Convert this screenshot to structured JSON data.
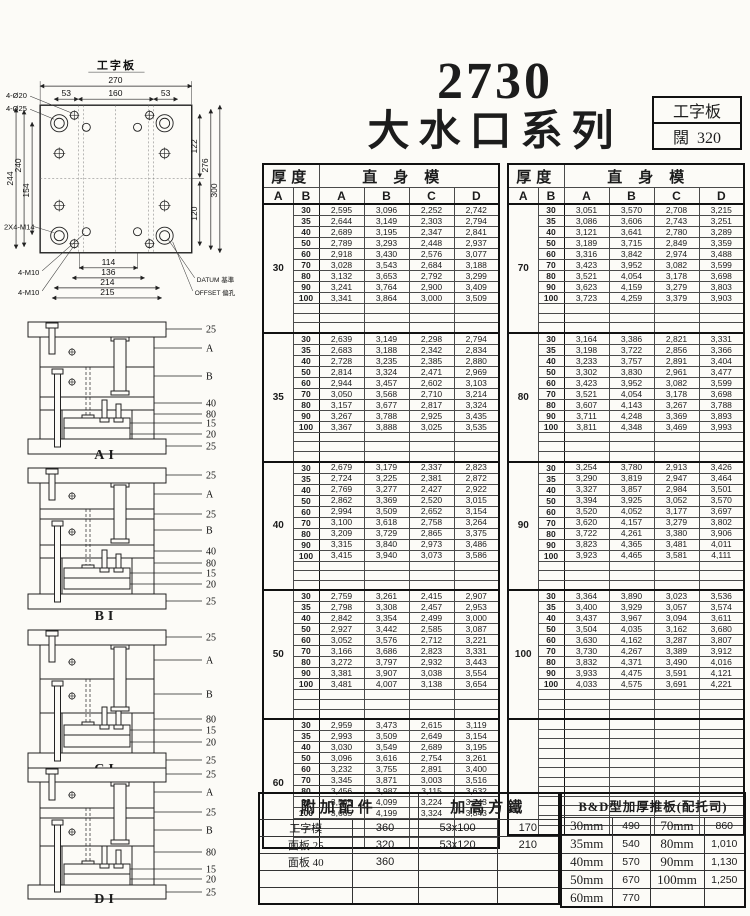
{
  "title": {
    "model": "2730",
    "series": "大水口系列"
  },
  "info_box": {
    "type": "工字板",
    "width_label": "闊",
    "width_value": "320"
  },
  "drawing": {
    "title": "工字板",
    "dim_270": "270",
    "dim_160": "160",
    "dim_53_left": "53",
    "dim_53_right": "53",
    "dim_244": "244",
    "dim_240": "240",
    "dim_154": "154",
    "dim_122": "122",
    "dim_120": "120",
    "dim_276": "276",
    "dim_300": "300",
    "dim_114": "114",
    "dim_136": "136",
    "dim_214": "214",
    "dim_215": "215",
    "label_holes_20": "4-Ø20",
    "label_holes_25": "4-Ø25",
    "label_m14": "2X4-M14",
    "label_m10_a": "4-M10",
    "label_m10_b": "4-M10",
    "label_datum": "DATUM 基準",
    "label_offset": "OFFSET 偏孔"
  },
  "diagrams": [
    {
      "name": "AI",
      "callouts": [
        "25",
        "A",
        "B",
        "40",
        "80",
        "15",
        "20",
        "25"
      ]
    },
    {
      "name": "BI",
      "callouts": [
        "25",
        "A",
        "25",
        "B",
        "40",
        "80",
        "15",
        "20",
        "25"
      ]
    },
    {
      "name": "CI",
      "callouts": [
        "25",
        "A",
        "B",
        "80",
        "15",
        "20",
        "25"
      ]
    },
    {
      "name": "DI",
      "callouts": [
        "25",
        "A",
        "25",
        "B",
        "80",
        "15",
        "20",
        "25"
      ]
    }
  ],
  "price_table": {
    "header": {
      "thickness": "厚度",
      "straight": "直身模",
      "a": "A",
      "b": "B",
      "col_a": "A",
      "col_b": "B",
      "col_c": "C",
      "col_d": "D"
    },
    "rows_per_block": 12,
    "right_trailing_empty_rows": 12,
    "left_blocks": [
      {
        "a": "30",
        "rows": [
          [
            "30",
            "2,595",
            "3,096",
            "2,252",
            "2,742"
          ],
          [
            "35",
            "2,644",
            "3,149",
            "2,303",
            "2,794"
          ],
          [
            "40",
            "2,689",
            "3,195",
            "2,347",
            "2,841"
          ],
          [
            "50",
            "2,789",
            "3,293",
            "2,448",
            "2,937"
          ],
          [
            "60",
            "2,918",
            "3,430",
            "2,576",
            "3,077"
          ],
          [
            "70",
            "3,028",
            "3,543",
            "2,684",
            "3,188"
          ],
          [
            "80",
            "3,132",
            "3,653",
            "2,792",
            "3,299"
          ],
          [
            "90",
            "3,241",
            "3,764",
            "2,900",
            "3,409"
          ],
          [
            "100",
            "3,341",
            "3,864",
            "3,000",
            "3,509"
          ]
        ]
      },
      {
        "a": "35",
        "rows": [
          [
            "30",
            "2,639",
            "3,149",
            "2,298",
            "2,794"
          ],
          [
            "35",
            "2,683",
            "3,188",
            "2,342",
            "2,834"
          ],
          [
            "40",
            "2,728",
            "3,235",
            "2,385",
            "2,880"
          ],
          [
            "50",
            "2,814",
            "3,324",
            "2,471",
            "2,969"
          ],
          [
            "60",
            "2,944",
            "3,457",
            "2,602",
            "3,103"
          ],
          [
            "70",
            "3,050",
            "3,568",
            "2,710",
            "3,214"
          ],
          [
            "80",
            "3,157",
            "3,677",
            "2,817",
            "3,324"
          ],
          [
            "90",
            "3,267",
            "3,788",
            "2,925",
            "3,435"
          ],
          [
            "100",
            "3,367",
            "3,888",
            "3,025",
            "3,535"
          ]
        ]
      },
      {
        "a": "40",
        "rows": [
          [
            "30",
            "2,679",
            "3,179",
            "2,337",
            "2,823"
          ],
          [
            "35",
            "2,724",
            "3,225",
            "2,381",
            "2,872"
          ],
          [
            "40",
            "2,769",
            "3,277",
            "2,427",
            "2,922"
          ],
          [
            "50",
            "2,862",
            "3,369",
            "2,520",
            "3,015"
          ],
          [
            "60",
            "2,994",
            "3,509",
            "2,652",
            "3,154"
          ],
          [
            "70",
            "3,100",
            "3,618",
            "2,758",
            "3,264"
          ],
          [
            "80",
            "3,209",
            "3,729",
            "2,865",
            "3,375"
          ],
          [
            "90",
            "3,315",
            "3,840",
            "2,973",
            "3,486"
          ],
          [
            "100",
            "3,415",
            "3,940",
            "3,073",
            "3,586"
          ]
        ]
      },
      {
        "a": "50",
        "rows": [
          [
            "30",
            "2,759",
            "3,261",
            "2,415",
            "2,907"
          ],
          [
            "35",
            "2,798",
            "3,308",
            "2,457",
            "2,953"
          ],
          [
            "40",
            "2,842",
            "3,354",
            "2,499",
            "3,000"
          ],
          [
            "50",
            "2,927",
            "3,442",
            "2,585",
            "3,087"
          ],
          [
            "60",
            "3,052",
            "3,576",
            "2,712",
            "3,221"
          ],
          [
            "70",
            "3,166",
            "3,686",
            "2,823",
            "3,331"
          ],
          [
            "80",
            "3,272",
            "3,797",
            "2,932",
            "3,443"
          ],
          [
            "90",
            "3,381",
            "3,907",
            "3,038",
            "3,554"
          ],
          [
            "100",
            "3,481",
            "4,007",
            "3,138",
            "3,654"
          ]
        ]
      },
      {
        "a": "60",
        "rows": [
          [
            "30",
            "2,959",
            "3,473",
            "2,615",
            "3,119"
          ],
          [
            "35",
            "2,993",
            "3,509",
            "2,649",
            "3,154"
          ],
          [
            "40",
            "3,030",
            "3,549",
            "2,689",
            "3,195"
          ],
          [
            "50",
            "3,096",
            "3,616",
            "2,754",
            "3,261"
          ],
          [
            "60",
            "3,232",
            "3,755",
            "2,891",
            "3,400"
          ],
          [
            "70",
            "3,345",
            "3,871",
            "3,003",
            "3,516"
          ],
          [
            "80",
            "3,456",
            "3,987",
            "3,115",
            "3,632"
          ],
          [
            "90",
            "3,565",
            "4,099",
            "3,224",
            "3,743"
          ],
          [
            "100",
            "3,665",
            "4,199",
            "3,324",
            "3,843"
          ]
        ]
      }
    ],
    "right_blocks": [
      {
        "a": "70",
        "rows": [
          [
            "30",
            "3,051",
            "3,570",
            "2,708",
            "3,215"
          ],
          [
            "35",
            "3,086",
            "3,606",
            "2,743",
            "3,251"
          ],
          [
            "40",
            "3,121",
            "3,641",
            "2,780",
            "3,289"
          ],
          [
            "50",
            "3,189",
            "3,715",
            "2,849",
            "3,359"
          ],
          [
            "60",
            "3,316",
            "3,842",
            "2,974",
            "3,488"
          ],
          [
            "70",
            "3,423",
            "3,952",
            "3,082",
            "3,599"
          ],
          [
            "80",
            "3,521",
            "4,054",
            "3,178",
            "3,698"
          ],
          [
            "90",
            "3,623",
            "4,159",
            "3,279",
            "3,803"
          ],
          [
            "100",
            "3,723",
            "4,259",
            "3,379",
            "3,903"
          ]
        ]
      },
      {
        "a": "80",
        "rows": [
          [
            "30",
            "3,164",
            "3,386",
            "2,821",
            "3,331"
          ],
          [
            "35",
            "3,198",
            "3,722",
            "2,856",
            "3,366"
          ],
          [
            "40",
            "3,233",
            "3,757",
            "2,891",
            "3,404"
          ],
          [
            "50",
            "3,302",
            "3,830",
            "2,961",
            "3,477"
          ],
          [
            "60",
            "3,423",
            "3,952",
            "3,082",
            "3,599"
          ],
          [
            "70",
            "3,521",
            "4,054",
            "3,178",
            "3,698"
          ],
          [
            "80",
            "3,607",
            "4,143",
            "3,267",
            "3,788"
          ],
          [
            "90",
            "3,711",
            "4,248",
            "3,369",
            "3,893"
          ],
          [
            "100",
            "3,811",
            "4,348",
            "3,469",
            "3,993"
          ]
        ]
      },
      {
        "a": "90",
        "rows": [
          [
            "30",
            "3,254",
            "3,780",
            "2,913",
            "3,426"
          ],
          [
            "35",
            "3,290",
            "3,819",
            "2,947",
            "3,464"
          ],
          [
            "40",
            "3,327",
            "3,857",
            "2,984",
            "3,501"
          ],
          [
            "50",
            "3,394",
            "3,925",
            "3,052",
            "3,570"
          ],
          [
            "60",
            "3,520",
            "4,052",
            "3,177",
            "3,697"
          ],
          [
            "70",
            "3,620",
            "4,157",
            "3,279",
            "3,802"
          ],
          [
            "80",
            "3,722",
            "4,261",
            "3,380",
            "3,906"
          ],
          [
            "90",
            "3,823",
            "4,365",
            "3,481",
            "4,011"
          ],
          [
            "100",
            "3,923",
            "4,465",
            "3,581",
            "4,111"
          ]
        ]
      },
      {
        "a": "100",
        "rows": [
          [
            "30",
            "3,364",
            "3,890",
            "3,023",
            "3,536"
          ],
          [
            "35",
            "3,400",
            "3,929",
            "3,057",
            "3,574"
          ],
          [
            "40",
            "3,437",
            "3,967",
            "3,094",
            "3,611"
          ],
          [
            "50",
            "3,504",
            "4,035",
            "3,162",
            "3,680"
          ],
          [
            "60",
            "3,630",
            "4,162",
            "3,287",
            "3,807"
          ],
          [
            "70",
            "3,730",
            "4,267",
            "3,389",
            "3,912"
          ],
          [
            "80",
            "3,832",
            "4,371",
            "3,490",
            "4,016"
          ],
          [
            "90",
            "3,933",
            "4,475",
            "3,591",
            "4,121"
          ],
          [
            "100",
            "4,033",
            "4,575",
            "3,691",
            "4,221"
          ]
        ]
      }
    ]
  },
  "bottom": {
    "visible_rows": 5,
    "accessories": {
      "title": "附加配件",
      "rows": [
        [
          "工字模",
          "360"
        ],
        [
          "面板 25",
          "320"
        ],
        [
          "面板 40",
          "360"
        ]
      ]
    },
    "risers": {
      "title": "加高方鐵",
      "rows": [
        [
          "53x100",
          "170"
        ],
        [
          "53x120",
          "210"
        ]
      ]
    },
    "bd": {
      "title": "B&D型加厚推板(配托司)",
      "rows": [
        [
          "30mm",
          "490",
          "70mm",
          "860"
        ],
        [
          "35mm",
          "540",
          "80mm",
          "1,010"
        ],
        [
          "40mm",
          "570",
          "90mm",
          "1,130"
        ],
        [
          "50mm",
          "670",
          "100mm",
          "1,250"
        ],
        [
          "60mm",
          "770",
          "",
          ""
        ]
      ]
    }
  }
}
